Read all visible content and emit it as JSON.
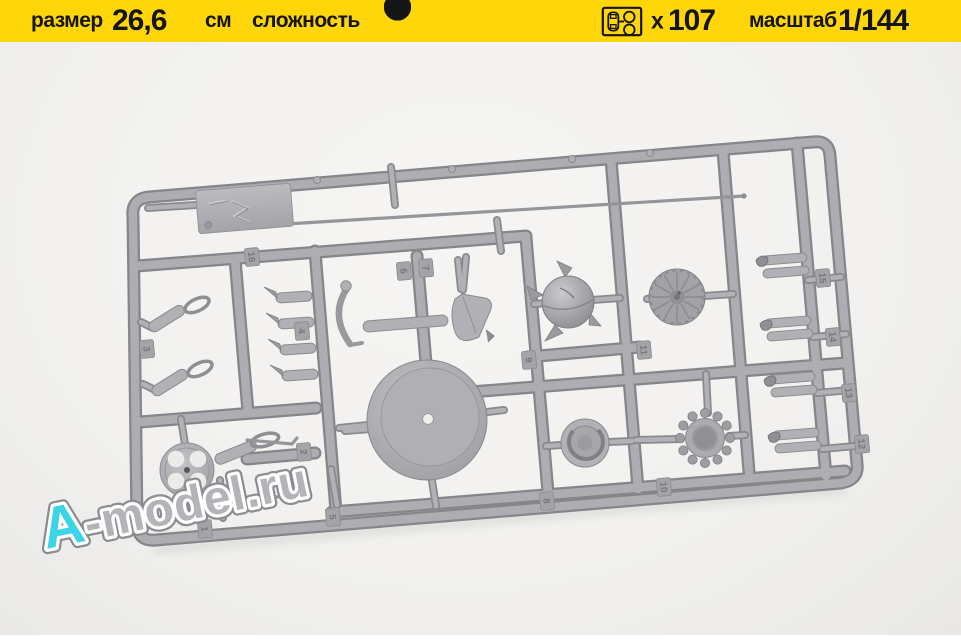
{
  "header": {
    "bg_color": "#ffd60a",
    "text_color": "#151515",
    "size": {
      "label": "размер",
      "value": "26,6",
      "unit": "см"
    },
    "difficulty": {
      "label": "сложность",
      "filled": 3,
      "total": 5
    },
    "parts": {
      "icon": "sprue-icon",
      "multiplier": "x",
      "count": "107"
    },
    "scale": {
      "label": "масштаб",
      "value": "1/144"
    }
  },
  "photo": {
    "watermark": {
      "accent_text": "A",
      "body_text": "-model.ru",
      "accent_color": "#3cd4e6",
      "body_color": "#b4b4b8"
    },
    "sprue": {
      "plastic_color": "#a9a9ad",
      "part_tags": [
        {
          "n": "16",
          "x": 252,
          "y": 257
        },
        {
          "n": "6",
          "x": 404,
          "y": 271
        },
        {
          "n": "7",
          "x": 426,
          "y": 268
        },
        {
          "n": "3",
          "x": 147,
          "y": 349
        },
        {
          "n": "4",
          "x": 302,
          "y": 331
        },
        {
          "n": "2",
          "x": 304,
          "y": 452
        },
        {
          "n": "1",
          "x": 205,
          "y": 529
        },
        {
          "n": "5",
          "x": 333,
          "y": 517
        },
        {
          "n": "9",
          "x": 529,
          "y": 360
        },
        {
          "n": "11",
          "x": 644,
          "y": 350
        },
        {
          "n": "8",
          "x": 547,
          "y": 501
        },
        {
          "n": "10",
          "x": 664,
          "y": 487
        },
        {
          "n": "15",
          "x": 823,
          "y": 278
        },
        {
          "n": "14",
          "x": 833,
          "y": 337
        },
        {
          "n": "13",
          "x": 849,
          "y": 393
        },
        {
          "n": "12",
          "x": 862,
          "y": 444
        }
      ],
      "ribbed_dome": {
        "cx": 677,
        "cy": 297,
        "ribs": 12
      },
      "beaded_ring": {
        "cx": 705,
        "cy": 438,
        "beads": 12
      }
    }
  }
}
